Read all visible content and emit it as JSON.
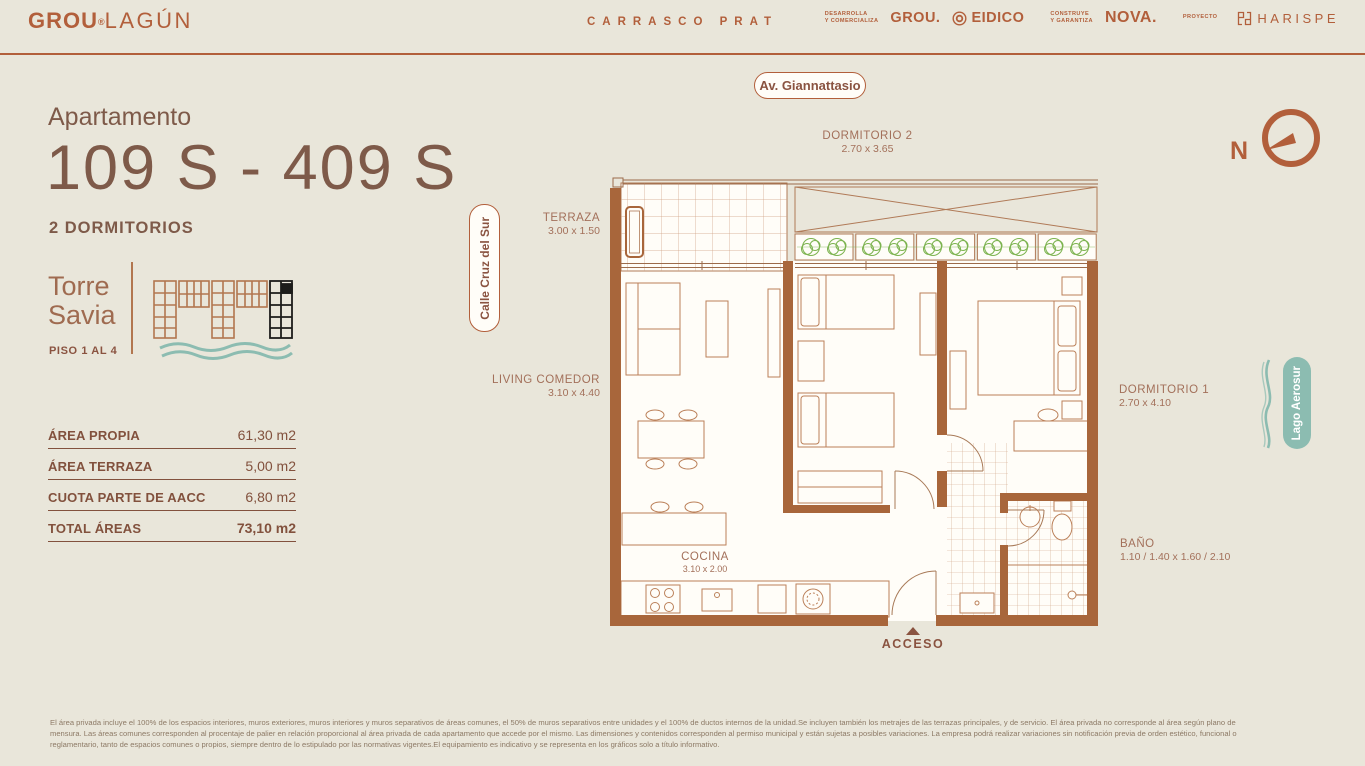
{
  "header": {
    "brand": {
      "part1": "GROU",
      "mark": "®",
      "part2": "LAGÚN"
    },
    "project": "CARRASCO PRAT",
    "partners": {
      "dev_role_line1": "DESARROLLA",
      "dev_role_line2": "Y COMERCIALIZA",
      "grou": "GROU.",
      "eidico": "EIDICO",
      "build_role_line1": "CONSTRUYE",
      "build_role_line2": "Y GARANTIZA",
      "nova": "NOVA.",
      "proyecto": "PROYECTO",
      "harispe": "HARISPE"
    }
  },
  "unit": {
    "label": "Apartamento",
    "number": "109 S - 409 S",
    "bedrooms": "2 DORMITORIOS"
  },
  "tower": {
    "name_line1": "Torre",
    "name_line2": "Savia",
    "floors": "PISO 1 AL 4"
  },
  "areas": {
    "rows": [
      {
        "label": "ÁREA PROPIA",
        "value": "61,30 m2"
      },
      {
        "label": "ÁREA TERRAZA",
        "value": "5,00 m2"
      },
      {
        "label": "CUOTA PARTE DE AACC",
        "value": "6,80 m2"
      },
      {
        "label": "TOTAL ÁREAS",
        "value": "73,10 m2"
      }
    ]
  },
  "context": {
    "street_top": "Av. Giannattasio",
    "street_left": "Calle Cruz del Sur",
    "lake": "Lago Aerosur",
    "north": "N"
  },
  "plan": {
    "rooms": [
      {
        "name": "DORMITORIO 2",
        "dims": "2.70 x 3.65"
      },
      {
        "name": "TERRAZA",
        "dims": "3.00 x 1.50"
      },
      {
        "name": "LIVING COMEDOR",
        "dims": "3.10 x 4.40"
      },
      {
        "name": "DORMITORIO 1",
        "dims": "2.70 x 4.10"
      },
      {
        "name": "COCINA",
        "dims": "3.10 x 2.00"
      },
      {
        "name": "BAÑO",
        "dims": "1.10 / 1.40 x 1.60 / 2.10"
      }
    ],
    "access": "ACCESO"
  },
  "footer": {
    "disclaimer": "El área privada incluye el 100% de los espacios interiores, muros exteriores, muros interiores y muros separativos de áreas comunes, el 50% de muros separativos entre unidades y el 100% de ductos internos de la unidad.Se incluyen también los metrajes de las terrazas principales, y de servicio. El área privada no corresponde al área según plano de mensura. Las áreas comunes corresponden al procentaje de palier en relación proporcional al área privada de cada apartamento que accede por el mismo. Las dimensiones y contenidos corresponden al permiso municipal y están sujetas a posibles variaciones. La empresa podrá realizar variaciones sin notificación previa de orden estético, funcional o reglamentario, tanto de espacios comunes o propios, siempre dentro de lo estipulado por las normativas vigentes.El equipamiento es indicativo y se representa en los gráficos solo a título informativo."
  },
  "colors": {
    "background": "#e9e6da",
    "accent": "#b25f3b",
    "heading": "#7e5a49",
    "wall": "#a8663b",
    "teal": "#8cbcb1",
    "plant_green": "#7cb34f"
  }
}
